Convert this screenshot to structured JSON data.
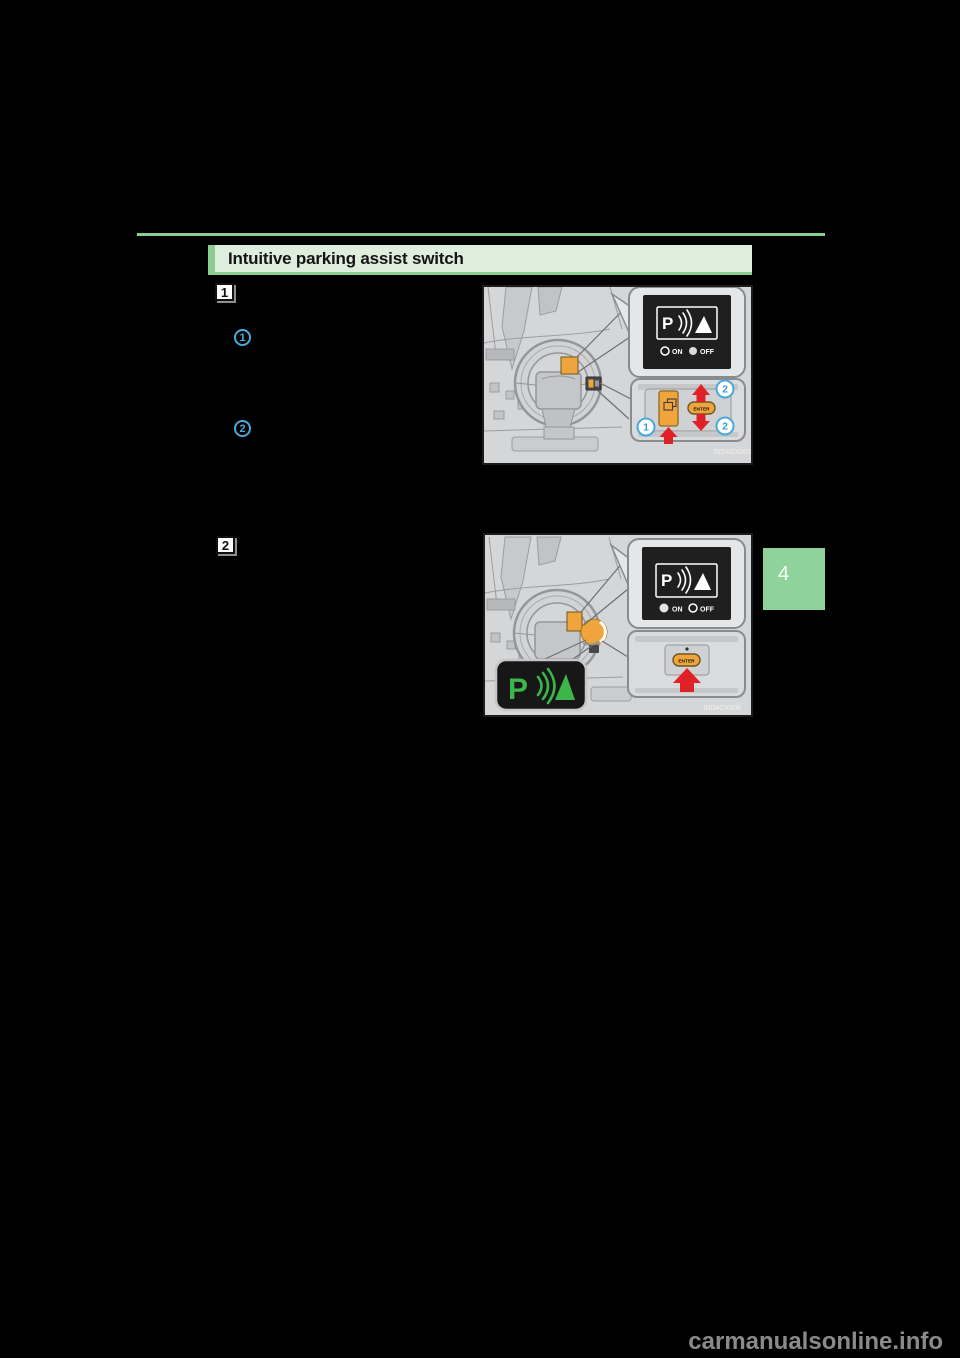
{
  "header": {
    "title": "Intuitive parking assist switch"
  },
  "steps": {
    "step1_label": "1",
    "step2_label": "2"
  },
  "margin_callouts": {
    "callout1_label": "1",
    "callout2_label": "2"
  },
  "chapter_tab": {
    "label": "4"
  },
  "fig1": {
    "code": "IND4GX005",
    "screen_icon": "intuitive-parking-assist-icon",
    "on_label": "ON",
    "off_label": "OFF",
    "selected": "OFF",
    "enter_label": "ENTER",
    "callout1_label": "1",
    "callout2_up_label": "2",
    "callout2_down_label": "2"
  },
  "fig2": {
    "code": "IND4GX006",
    "screen_icon": "intuitive-parking-assist-icon",
    "on_label": "ON",
    "off_label": "OFF",
    "selected": "ON",
    "enter_label": "ENTER"
  },
  "watermark": {
    "text": "carmanualsonline.info"
  },
  "colors": {
    "page_bg": "#000000",
    "rule_green": "#8ccd92",
    "header_bg": "#ddefdc",
    "tab_green": "#90d39a",
    "highlight_orange": "#f0a43c",
    "arrow_red": "#e02128",
    "assist_green": "#3cb54a",
    "callout_blue": "#4aa9d9",
    "watermark_gray": "#8a8a8a"
  }
}
